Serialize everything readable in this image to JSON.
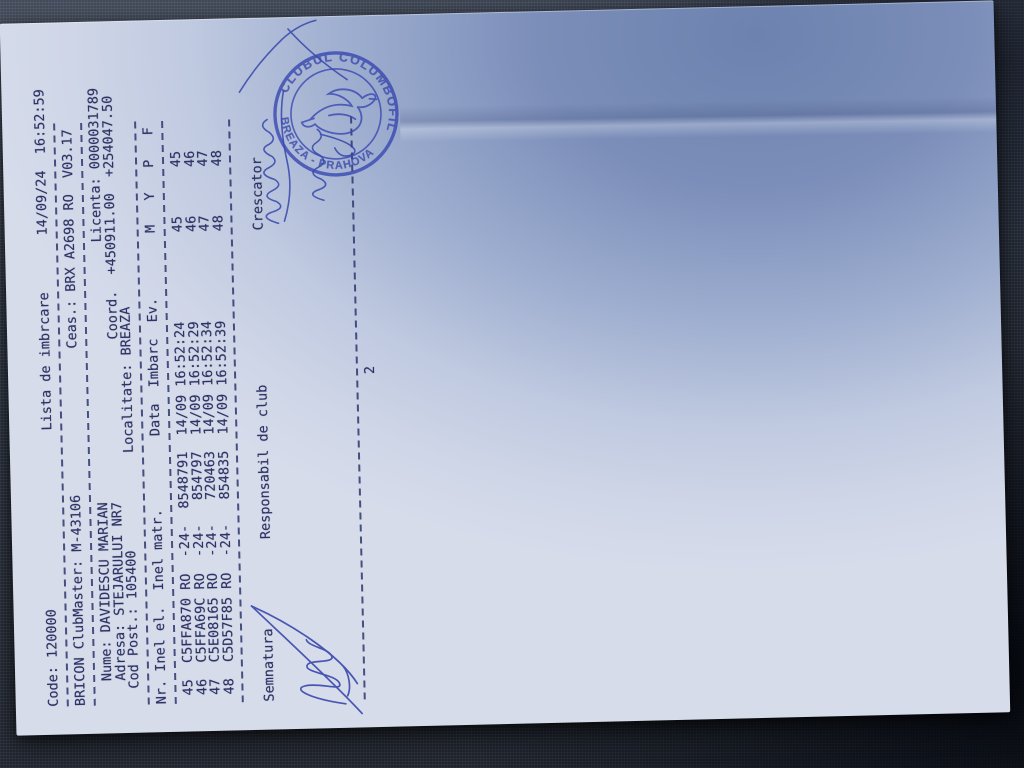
{
  "doc": {
    "header": {
      "code": "Code: 120000",
      "title": "Lista de imbrcare",
      "datetime": "14/09/24  16:52:59",
      "clubmaster": "BRICON ClubMaster: M-43106",
      "clock": "Ceas.: BRX A2698 RO  V03.17",
      "name": "Nume: DAVIDESCU MARIAN",
      "license": "Licenta: 0000031789",
      "address": "Adresa: STEJARULUI NR7",
      "coord": "Coord.  +450911.00  +254047.50",
      "postal": "Cod Post.: 105400",
      "locality": "Localitate: BREAZA"
    },
    "table": {
      "headers": {
        "nr": "Nr.",
        "inel_el": "Inel el.",
        "inel_matr": "Inel matr.",
        "data": "Data",
        "imbarc": "Imbarc",
        "ev": "Ev.",
        "m": "M",
        "y": "Y",
        "p": "P",
        "f": "F"
      },
      "rows": [
        {
          "nr": "45",
          "ring": "C5FFA870 RO  -24-",
          "matr": "8548791",
          "date": "14/09",
          "time": "16:52:24",
          "m": "45",
          "p": "45"
        },
        {
          "nr": "46",
          "ring": "C5FFA69C RO  -24-",
          "matr": "854797",
          "date": "14/09",
          "time": "16:52:29",
          "m": "46",
          "p": "46"
        },
        {
          "nr": "47",
          "ring": "C5E08165 RO  -24-",
          "matr": "720463",
          "date": "14/09",
          "time": "16:52:34",
          "m": "47",
          "p": "47"
        },
        {
          "nr": "48",
          "ring": "C5D57F85 RO  -24-",
          "matr": "854835",
          "date": "14/09",
          "time": "16:52:39",
          "m": "48",
          "p": "48"
        }
      ]
    },
    "footer": {
      "semnatura": "Semnatura",
      "responsabil": "Responsabil de club",
      "crescator": "Crescator",
      "page_number": "2"
    },
    "stamp": {
      "ring_top": "CLUBUL COLUMBOFIL",
      "ring_bottom": "BREAZA - PRAHOVA",
      "ink_color": "#3a49b2"
    },
    "colors": {
      "print_ink": "#2c3263",
      "pen_ink": "#2f3fa8",
      "paper": "#cfd6e7"
    }
  }
}
